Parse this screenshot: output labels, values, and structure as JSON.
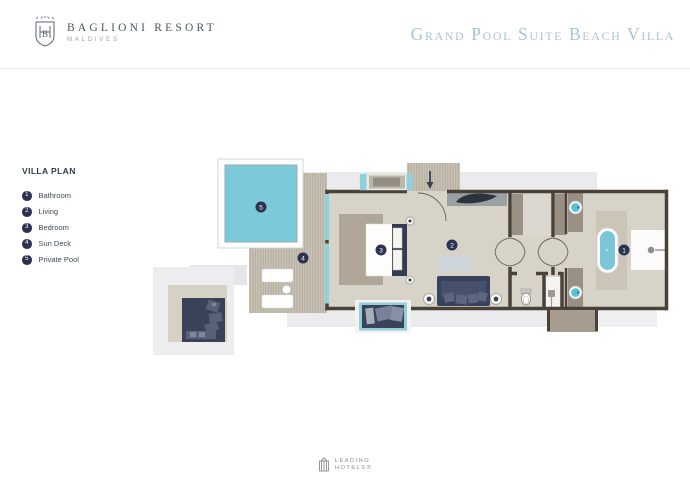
{
  "header": {
    "brand_name": "BAGLIONI  RESORT",
    "brand_location": "MALDIVES",
    "title": "Grand Pool Suite Beach Villa"
  },
  "legend": {
    "heading": "VILLA PLAN",
    "items": [
      {
        "num": "1",
        "label": "Bathroom"
      },
      {
        "num": "2",
        "label": "Living"
      },
      {
        "num": "3",
        "label": "Bedroom"
      },
      {
        "num": "4",
        "label": "Sun Deck"
      },
      {
        "num": "5",
        "label": "Private Pool"
      }
    ]
  },
  "plan": {
    "markers": [
      {
        "num": "1",
        "label": "Bathroom",
        "x": 624,
        "y": 250
      },
      {
        "num": "2",
        "label": "Living",
        "x": 452,
        "y": 245
      },
      {
        "num": "3",
        "label": "Bedroom",
        "x": 381,
        "y": 250
      },
      {
        "num": "4",
        "label": "Sun Deck",
        "x": 303,
        "y": 258
      },
      {
        "num": "5",
        "label": "Private Pool",
        "x": 261,
        "y": 207
      }
    ]
  },
  "footer": {
    "logo_line1": "LEADING",
    "logo_line2": "HOTELS®"
  },
  "colors": {
    "title_blue": "#a9c4d3",
    "navy": "#2c3352",
    "pool_cyan": "#7cc9da",
    "window_cyan": "#8fd0dc",
    "wall_brown": "#4a4238",
    "floor": "#d7d3c9",
    "deck": "#c9c3b5",
    "taupe": "#998f83",
    "rug": "#b0a698",
    "shadow": "#ebebee"
  }
}
